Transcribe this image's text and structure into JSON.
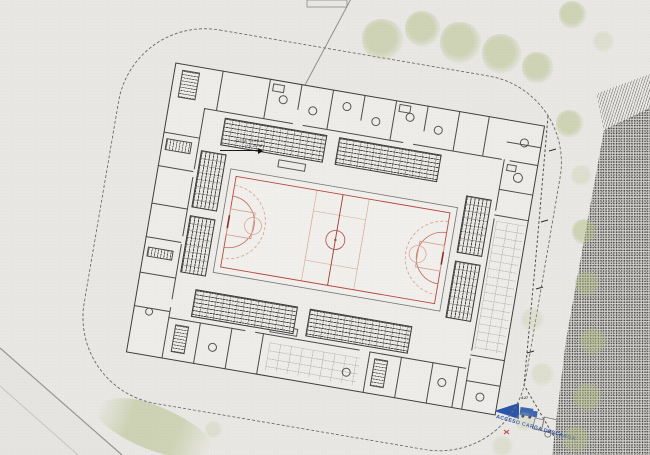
{
  "plan": {
    "title": "Sports pavilion site plan",
    "court": "multi-sport court with basketball and handball markings"
  },
  "annotations": {
    "cota_line1": "COTA +4.50 M",
    "cota_line2": "(+1.20 M)",
    "dim_label": "4.27",
    "acceso_label": "ACCESO CARGA DESCARGA"
  },
  "icons": {
    "access_arrow_icon": "◀",
    "truck_icon": "solid truck silhouette",
    "truck_outline_icon": "truck outline drawing",
    "tree_icon": "canopy blob"
  },
  "colors": {
    "paper": "#e8e7e3",
    "wall": "#454545",
    "court_red": "#b5473d",
    "court_salmon": "#d79c8b",
    "accent_blue": "#2a55a8",
    "tree_green": "#b2be86",
    "stipple_gray": "#d4d2ce"
  }
}
